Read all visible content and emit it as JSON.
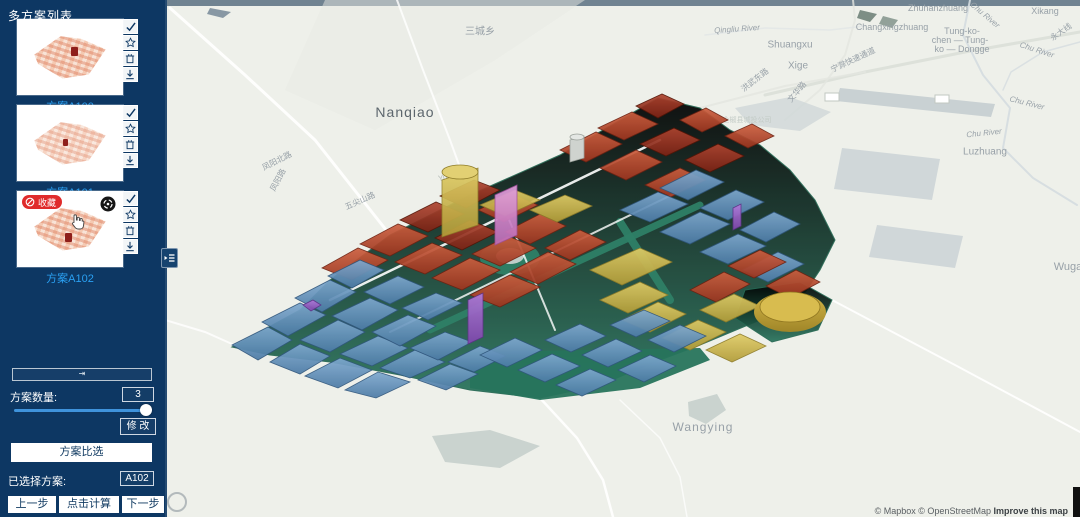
{
  "sidebar": {
    "title": "多方案列表",
    "schemes": [
      {
        "label": "方案A100"
      },
      {
        "label": "方案A101"
      },
      {
        "label": "方案A102",
        "badge": "收藏"
      }
    ],
    "thumb_icons": [
      "check-icon",
      "star-icon",
      "trash-icon",
      "download-icon"
    ],
    "collapse_glyph": "⇥",
    "scheme_count_label": "方案数量:",
    "scheme_count_value": "3",
    "modify_button": "修 改",
    "compare_button": "方案比选",
    "selected_label": "已选择方案:",
    "selected_value": "A102",
    "prev_button": "上一步",
    "calc_button": "点击计算",
    "next_button": "下一步"
  },
  "colors": {
    "sidebar_bg": "#0d3763",
    "scheme_label_blue": "#2aa0f2",
    "badge_red": "#e02b2b",
    "slider_blue": "#3f93dc",
    "model_blue": "#5d8cb8",
    "model_red": "#b34a2e",
    "model_yellow": "#cdb94e",
    "model_purple": "#9a63c8",
    "model_green": "#2e8066"
  },
  "map": {
    "attribution": {
      "prefix": "© Mapbox © OpenStreetMap ",
      "link": "Improve this map"
    },
    "labels": [
      {
        "t": "三城乡",
        "x": 315,
        "y": 30,
        "fs": 10
      },
      {
        "t": "Nanqiao",
        "x": 240,
        "y": 112,
        "fs": 14,
        "c": "#5c666d",
        "ls": 1
      },
      {
        "t": "Wangying",
        "x": 538,
        "y": 427,
        "fs": 12,
        "ls": 1
      },
      {
        "t": "Shuangxu",
        "x": 625,
        "y": 45,
        "fs": 10
      },
      {
        "t": "Xige",
        "x": 633,
        "y": 66,
        "fs": 10
      },
      {
        "t": "Zhuhanzhuang",
        "x": 773,
        "y": 8,
        "fs": 9
      },
      {
        "t": "Changxingzhuang",
        "x": 727,
        "y": 27,
        "fs": 9
      },
      {
        "t": "Tung-ko-",
        "x": 797,
        "y": 31,
        "fs": 9
      },
      {
        "t": "chen — Tung-",
        "x": 795,
        "y": 40,
        "fs": 9
      },
      {
        "t": "ko — Dongge",
        "x": 797,
        "y": 49,
        "fs": 9
      },
      {
        "t": "Xikang",
        "x": 880,
        "y": 11,
        "fs": 9
      },
      {
        "t": "Chu River",
        "x": 820,
        "y": 15,
        "fs": 8,
        "i": 1,
        "r": 40
      },
      {
        "t": "Chu River",
        "x": 872,
        "y": 50,
        "fs": 8,
        "i": 1,
        "r": 18
      },
      {
        "t": "Chu River",
        "x": 819,
        "y": 133,
        "fs": 8,
        "i": 1,
        "r": -6
      },
      {
        "t": "Chu River",
        "x": 862,
        "y": 103,
        "fs": 8,
        "i": 1,
        "r": 14
      },
      {
        "t": "Luzhuang",
        "x": 820,
        "y": 152,
        "fs": 10
      },
      {
        "t": "Wuga",
        "x": 903,
        "y": 267,
        "fs": 11
      },
      {
        "t": "Qingliu River",
        "x": 572,
        "y": 29,
        "fs": 8,
        "i": 1,
        "r": -4
      },
      {
        "t": "宁滁快速通道",
        "x": 688,
        "y": 60,
        "fs": 8,
        "r": -25
      },
      {
        "t": "洪武东路",
        "x": 590,
        "y": 80,
        "fs": 8,
        "r": -38
      },
      {
        "t": "文华路",
        "x": 632,
        "y": 92,
        "fs": 8,
        "r": -50
      },
      {
        "t": "永大线",
        "x": 896,
        "y": 32,
        "fs": 8,
        "r": -35
      },
      {
        "t": "凤阳北路",
        "x": 112,
        "y": 161,
        "fs": 8,
        "r": -27
      },
      {
        "t": "凤阳路",
        "x": 113,
        "y": 180,
        "fs": 8,
        "r": -62
      },
      {
        "t": "五尖山路",
        "x": 195,
        "y": 201,
        "fs": 8,
        "r": -24
      },
      {
        "t": "Yulan",
        "x": 283,
        "y": 177,
        "fs": 8,
        "c": "#b4bbb6",
        "r": -10
      },
      {
        "t": "全椒县城投公司",
        "x": 582,
        "y": 120,
        "fs": 7,
        "c": "#c3cbc6"
      }
    ],
    "base_shapes": [
      {
        "p": "0,0 915,0 915,6 0,6",
        "f": "#5e7384",
        "o": 0.88
      },
      {
        "p": "160,0 420,0 330,60 210,130 120,90",
        "f": "#e8eae3",
        "o": 0.5
      },
      {
        "ln": "5,8 80,75 150,140 225,235",
        "s": "#ffffff",
        "w": 3,
        "o": 0.9
      },
      {
        "ln": "232,0 258,70 285,140 305,195",
        "s": "#ffffff",
        "w": 2,
        "o": 0.8
      },
      {
        "ln": "0,320 40,332 67,344",
        "s": "#ffffff",
        "w": 2,
        "o": 0.8
      },
      {
        "ln": "375,398 412,438 438,480 448,517",
        "s": "#ffffff",
        "w": 2.5,
        "o": 0.9
      },
      {
        "ln": "455,400 495,438 515,477 522,517",
        "s": "#ffffff",
        "w": 1.5,
        "o": 0.7
      },
      {
        "ln": "667,300 790,365 915,432",
        "s": "#ffffff",
        "w": 2,
        "o": 0.9
      },
      {
        "ln": "600,95 700,72 800,52 915,32",
        "s": "#dadfd8",
        "w": 3,
        "o": 0.9
      },
      {
        "ln": "535,108 620,86 700,72",
        "s": "#e3e6e0",
        "w": 2,
        "o": 0.8
      },
      {
        "ln": "620,120 655,90 680,55 690,20 688,0",
        "s": "#e3e6e0",
        "w": 2,
        "o": 0.8
      },
      {
        "ln": "805,0 798,35 818,75 845,108 838,148 868,178 912,205",
        "s": "#d4dce0",
        "w": 2,
        "o": 0.9
      },
      {
        "ln": "915,42 878,52 846,72 838,90",
        "s": "#d4dce0",
        "w": 1.5,
        "o": 0.8
      },
      {
        "ln": "540,35 600,28 665,30 700,26",
        "s": "#dfe4e6",
        "w": 1.5,
        "o": 0.7
      },
      {
        "p": "675,88 830,104 826,117 671,101",
        "f": "#c6cfd2",
        "o": 0.95
      },
      {
        "p": "677,148 775,159 767,200 669,189",
        "f": "#ccd4d7",
        "o": 0.9
      },
      {
        "p": "712,225 798,236 790,268 704,257",
        "f": "#ccd4d7",
        "o": 0.9
      },
      {
        "p": "570,108 625,97 666,112 635,131 585,125",
        "f": "#cfd7d8",
        "o": 0.8
      },
      {
        "p": "267,436 325,430 375,446 335,468 280,462",
        "f": "#c5cfcc",
        "o": 0.9
      },
      {
        "p": "523,402 552,394 561,410 541,424 524,416",
        "f": "#c5cfcc",
        "o": 0.9
      },
      {
        "p": "695,10 712,14 705,22 692,18",
        "f": "#70837a",
        "o": 0.9
      },
      {
        "p": "718,16 733,20 727,28 714,24",
        "f": "#7b8d84",
        "o": 0.8
      },
      {
        "p": "45,8 66,12 58,18 42,14",
        "f": "#6e8292",
        "o": 0.8
      },
      {
        "p": "660,93 674,93 674,101 660,101",
        "f": "#ffffff",
        "s": "#c2c8c2",
        "w": 1
      },
      {
        "p": "770,95 784,95 784,103 770,103",
        "f": "#ffffff",
        "s": "#c2c8c2",
        "w": 1
      },
      {
        "el": [
          12,
          502,
          9,
          9
        ],
        "f": "none",
        "s": "#9aa3a8",
        "w": 2,
        "o": 0.7
      }
    ],
    "model_shapes": [
      {
        "p": "67,347 135,310 165,280 225,235 305,195 395,155 455,120 493,98 535,108 565,130 595,145 625,170 650,200 670,240 655,270 635,300 595,320 535,345 495,360 435,385 375,398 305,390 235,375 165,362 105,355",
        "f": "green",
        "s": "#246752",
        "w": 1
      },
      {
        "p": "305,352 535,348 545,360 475,388 375,400 305,388",
        "f": "#27745c",
        "o": 0.95
      },
      {
        "p": "580,290 635,282 667,300 653,330 607,342 570,318",
        "f": "green",
        "s": "#246752",
        "w": 1
      },
      {
        "ln": "265,330 535,205",
        "s": "#2e8066",
        "w": 7,
        "o": 0.95
      },
      {
        "ln": "455,222 505,300",
        "s": "#2e8066",
        "w": 8,
        "o": 0.95
      },
      {
        "el": [
          345,
          258,
          30,
          17
        ],
        "f": "#2e8066",
        "o": 0.95
      },
      {
        "el": [
          345,
          256,
          14,
          8
        ],
        "f": "#cfd7d4",
        "o": 0.9
      },
      {
        "ln": "165,300 495,140",
        "s": "#ffffff",
        "w": 2.5,
        "o": 0.9
      },
      {
        "ln": "225,332 525,186",
        "s": "#ffffff",
        "w": 2,
        "o": 0.8
      },
      {
        "ln": "340,210 390,330",
        "s": "#ffffff",
        "w": 2,
        "o": 0.8
      },
      {
        "p": "395,150 431,132 457,144 421,162",
        "f": "red"
      },
      {
        "p": "433,128 467,112 493,124 459,140",
        "f": "red"
      },
      {
        "p": "471,106 497,94 519,104 493,118",
        "f": "darkred"
      },
      {
        "p": "435,168 471,150 497,162 461,180",
        "f": "red"
      },
      {
        "p": "475,144 509,128 535,140 501,156",
        "f": "darkred"
      },
      {
        "p": "515,120 541,108 563,120 537,132",
        "f": "red"
      },
      {
        "p": "480,185 515,168 541,180 506,197",
        "f": "red"
      },
      {
        "p": "520,160 553,144 579,156 545,172",
        "f": "darkred"
      },
      {
        "p": "560,136 587,124 609,136 583,148",
        "f": "red"
      },
      {
        "p": "275,196 309,180 335,190 301,208",
        "f": "darkred"
      },
      {
        "p": "313,210 347,194 373,205 339,222",
        "f": "red"
      },
      {
        "p": "405,140 419,136 419,158 405,162",
        "f": "#cfd3cf",
        "s": "#9aa09a",
        "w": 0.8
      },
      {
        "el": [
          412,
          137,
          7,
          3
        ],
        "f": "#e4e7e4",
        "s": "#9aa09a",
        "w": 0.8
      },
      {
        "p": "157,268 193,248 223,260 187,280",
        "f": "red"
      },
      {
        "p": "195,244 233,224 263,236 225,256",
        "f": "red"
      },
      {
        "p": "235,220 271,202 299,214 263,232",
        "f": "darkred"
      },
      {
        "p": "230,262 267,243 297,255 260,274",
        "f": "red"
      },
      {
        "p": "270,238 305,220 333,232 297,250",
        "f": "darkred"
      },
      {
        "p": "267,278 305,258 335,270 297,290",
        "f": "red"
      },
      {
        "p": "307,254 343,236 371,248 335,266",
        "f": "red"
      },
      {
        "p": "340,232 375,214 401,226 365,244",
        "f": "red"
      },
      {
        "p": "305,295 345,275 375,287 335,307",
        "f": "red"
      },
      {
        "p": "345,272 383,252 411,264 373,284",
        "f": "red"
      },
      {
        "p": "380,248 415,230 441,242 405,260",
        "f": "red"
      },
      {
        "p": "277,180 313,168 313,225 277,237",
        "f": "yellow"
      },
      {
        "el": [
          295,
          172,
          18,
          7
        ],
        "f": "#e2d073",
        "s": "#8f7d2a",
        "w": 0.8
      },
      {
        "p": "315,205 350,190 375,200 340,216",
        "f": "yellow"
      },
      {
        "p": "365,210 400,195 427,206 392,222",
        "f": "yellow"
      },
      {
        "p": "330,195 352,185 352,235 330,245",
        "f": "pink"
      },
      {
        "p": "425,270 475,248 507,262 457,285",
        "f": "yellow"
      },
      {
        "p": "435,300 475,282 503,295 463,313",
        "f": "yellow"
      },
      {
        "p": "455,210 493,192 523,204 485,222",
        "f": "blue"
      },
      {
        "p": "495,188 531,170 559,182 523,200",
        "f": "blue"
      },
      {
        "p": "495,232 535,212 565,224 525,244",
        "f": "blue"
      },
      {
        "p": "535,208 571,190 599,202 563,220",
        "f": "blue"
      },
      {
        "p": "535,252 573,234 601,246 563,264",
        "f": "blue"
      },
      {
        "p": "575,230 609,212 635,224 601,242",
        "f": "blue"
      },
      {
        "p": "577,270 613,252 639,264 603,282",
        "f": "blue"
      },
      {
        "p": "568,208 576,204 576,226 568,230",
        "f": "purple"
      },
      {
        "p": "525,290 559,272 585,284 551,302",
        "f": "red"
      },
      {
        "p": "563,266 595,250 621,262 589,278",
        "f": "red"
      },
      {
        "p": "601,286 631,270 655,282 625,298",
        "f": "red"
      },
      {
        "p": "457,320 493,302 521,314 485,332",
        "f": "yellow"
      },
      {
        "p": "497,338 533,320 561,332 525,350",
        "f": "yellow"
      },
      {
        "p": "535,310 569,294 595,306 561,322",
        "f": "yellow"
      },
      {
        "p": "541,350 575,334 601,346 567,362",
        "f": "yellow"
      },
      {
        "el": [
          625,
          312,
          36,
          20
        ],
        "f": "gold"
      },
      {
        "el": [
          625,
          307,
          30,
          15
        ],
        "f": "#d8bc4f",
        "s": "#8f7620",
        "w": 0.8
      },
      {
        "p": "67,345 103,327 127,340 93,360",
        "f": "blue"
      },
      {
        "p": "105,362 135,344 165,356 135,374",
        "f": "blue"
      },
      {
        "p": "140,376 175,358 207,370 173,388",
        "f": "blue"
      },
      {
        "p": "180,390 213,372 245,382 211,398",
        "f": "blue"
      },
      {
        "p": "97,322 135,303 161,315 123,336",
        "f": "blue"
      },
      {
        "p": "135,340 173,320 200,332 165,352",
        "f": "blue"
      },
      {
        "p": "175,354 213,336 243,348 207,366",
        "f": "blue"
      },
      {
        "p": "215,368 250,350 280,362 245,378",
        "f": "blue"
      },
      {
        "p": "253,380 285,364 313,374 281,390",
        "f": "blue"
      },
      {
        "p": "130,298 165,280 191,292 157,312",
        "f": "blue"
      },
      {
        "p": "167,316 205,298 233,310 197,330",
        "f": "blue"
      },
      {
        "p": "207,332 243,315 271,326 235,346",
        "f": "blue"
      },
      {
        "p": "245,348 280,332 307,342 273,360",
        "f": "blue"
      },
      {
        "p": "283,362 315,346 341,356 309,372",
        "f": "blue"
      },
      {
        "p": "163,276 195,260 219,270 187,288",
        "f": "blue"
      },
      {
        "p": "199,292 233,276 259,287 225,304",
        "f": "blue"
      },
      {
        "p": "237,308 271,293 297,303 263,320",
        "f": "blue"
      },
      {
        "p": "138,305 148,300 156,305 146,311",
        "f": "purple"
      },
      {
        "p": "303,300 318,293 318,337 303,344",
        "f": "purple"
      },
      {
        "p": "315,355 350,338 377,350 342,367",
        "f": "blue"
      },
      {
        "p": "353,370 387,354 415,366 380,382",
        "f": "blue"
      },
      {
        "p": "391,385 425,369 451,380 417,396",
        "f": "blue"
      },
      {
        "p": "380,340 415,324 441,336 406,352",
        "f": "blue"
      },
      {
        "p": "417,355 451,339 477,351 443,367",
        "f": "blue"
      },
      {
        "p": "453,370 485,355 511,366 479,382",
        "f": "blue"
      },
      {
        "p": "445,325 479,310 505,321 471,337",
        "f": "blue"
      },
      {
        "p": "483,340 515,325 541,336 509,352",
        "f": "blue"
      }
    ]
  }
}
